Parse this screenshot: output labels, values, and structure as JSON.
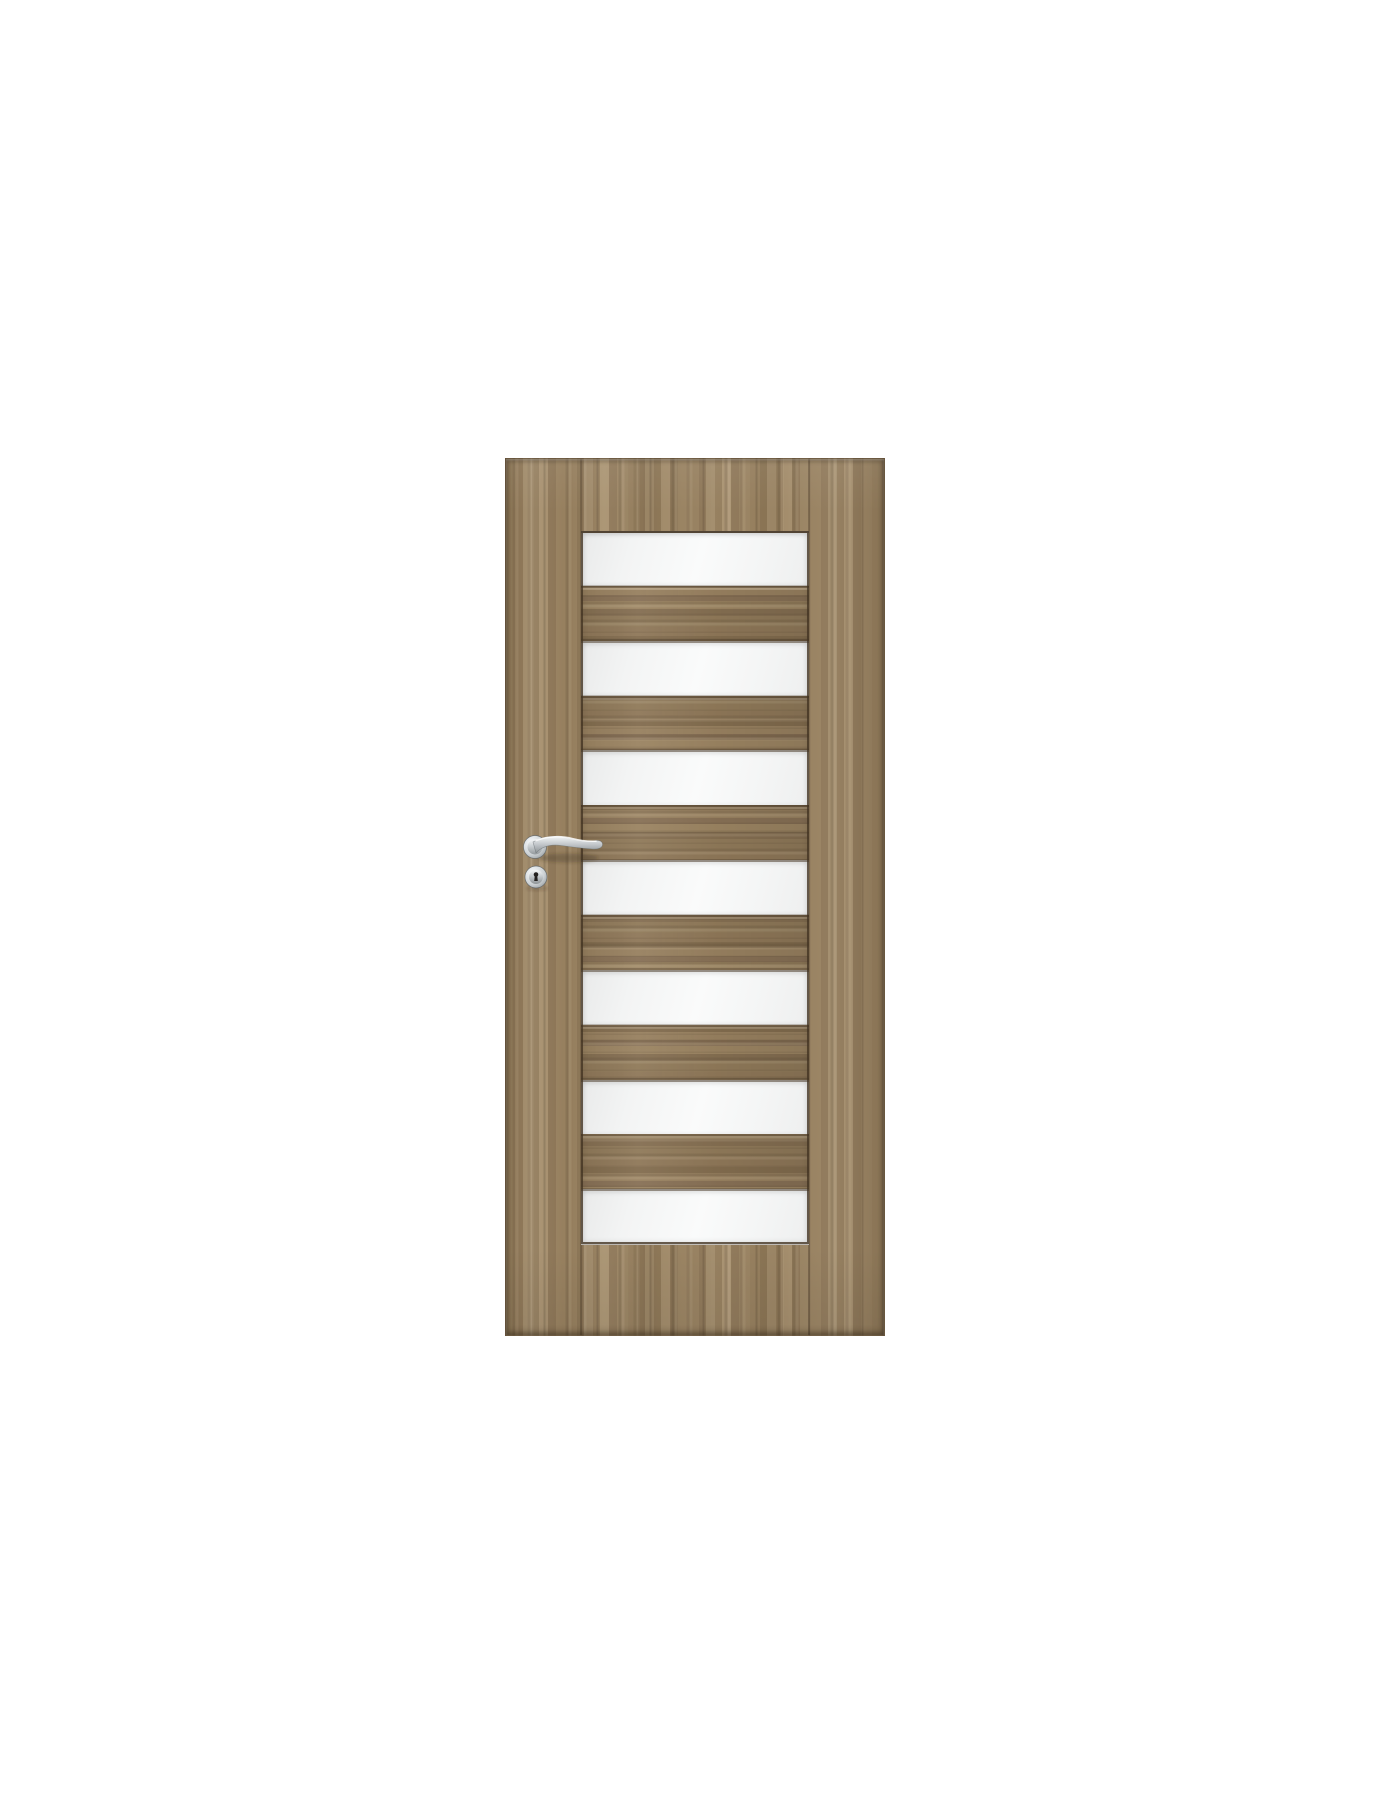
{
  "scene": {
    "description": "Front-view product photo of an interior wooden door with seven horizontal frosted glass slats and chrome lever handle on a plain white background",
    "background_color": "#ffffff"
  },
  "theme": {
    "background": "#ffffff",
    "wood_base": "#97805f",
    "wood_dark": "#6e5a41",
    "wood_light": "#b7a183",
    "slat_base": "#8e7758",
    "frame_line": "rgba(66,51,34,0.8)",
    "glass_light": "#fafbfb",
    "glass_shade": "#e9eaea",
    "chrome_light": "#f4f6f7",
    "chrome_mid": "#c6cbce",
    "chrome_dark": "#8d9396"
  },
  "door": {
    "position": {
      "left": 505,
      "top": 458,
      "width": 380,
      "height": 878
    },
    "glazing": {
      "left": 75,
      "top": 72,
      "width": 228,
      "height": 713
    },
    "panel_count": 7,
    "slat_count": 6,
    "wood_finish": "walnut laminate, vertical grain stiles, horizontal grain slats",
    "glass_finish": "frosted white"
  },
  "hardware": {
    "finish": "chrome",
    "container": {
      "left": 0,
      "top": 355,
      "width": 120,
      "height": 95
    },
    "rosette": {
      "cx": 29,
      "cy": 33,
      "r": 11.5
    },
    "lever_tip_x": 93,
    "escutcheon": {
      "cx": 30,
      "cy": 63,
      "r": 11
    },
    "keyhole_color": "#242220"
  }
}
